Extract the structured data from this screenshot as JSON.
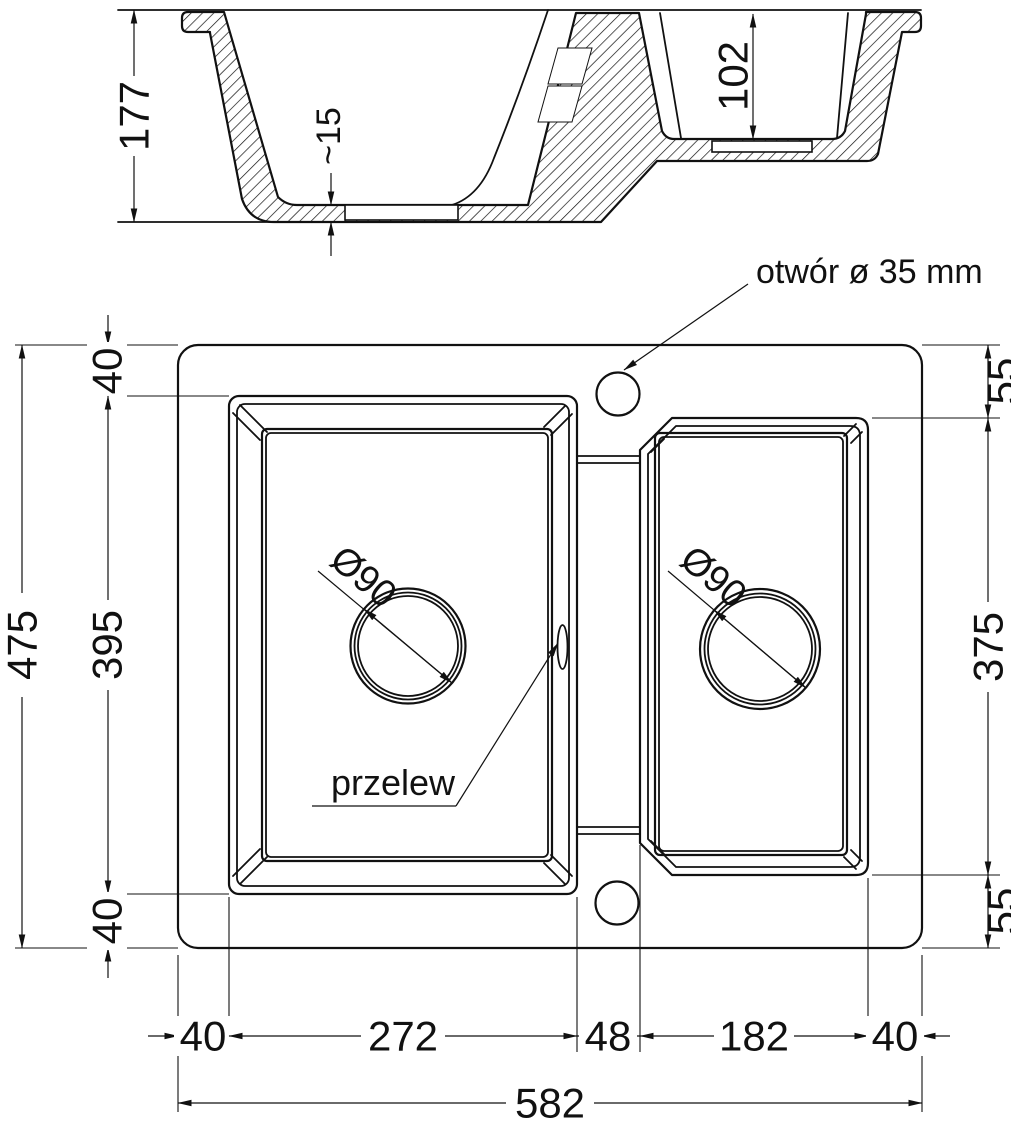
{
  "colors": {
    "line": "#111111",
    "background": "#ffffff"
  },
  "section_view": {
    "overall_height": "177",
    "floor_thickness": "~15",
    "second_bowl_depth": "102"
  },
  "plan_view": {
    "tap_hole_label": "otwór ø 35 mm",
    "overflow_label": "przelew",
    "main_bowl_drain": "Ø90",
    "second_bowl_drain": "Ø90",
    "left_chain": {
      "top": "40",
      "middle": "395",
      "bottom": "40",
      "overall": "475"
    },
    "right_chain": {
      "top": "55",
      "middle": "375",
      "bottom": "55"
    },
    "bottom_chain": {
      "seg1": "40",
      "seg2": "272",
      "seg3": "48",
      "seg4": "182",
      "seg5": "40",
      "overall": "582"
    }
  }
}
